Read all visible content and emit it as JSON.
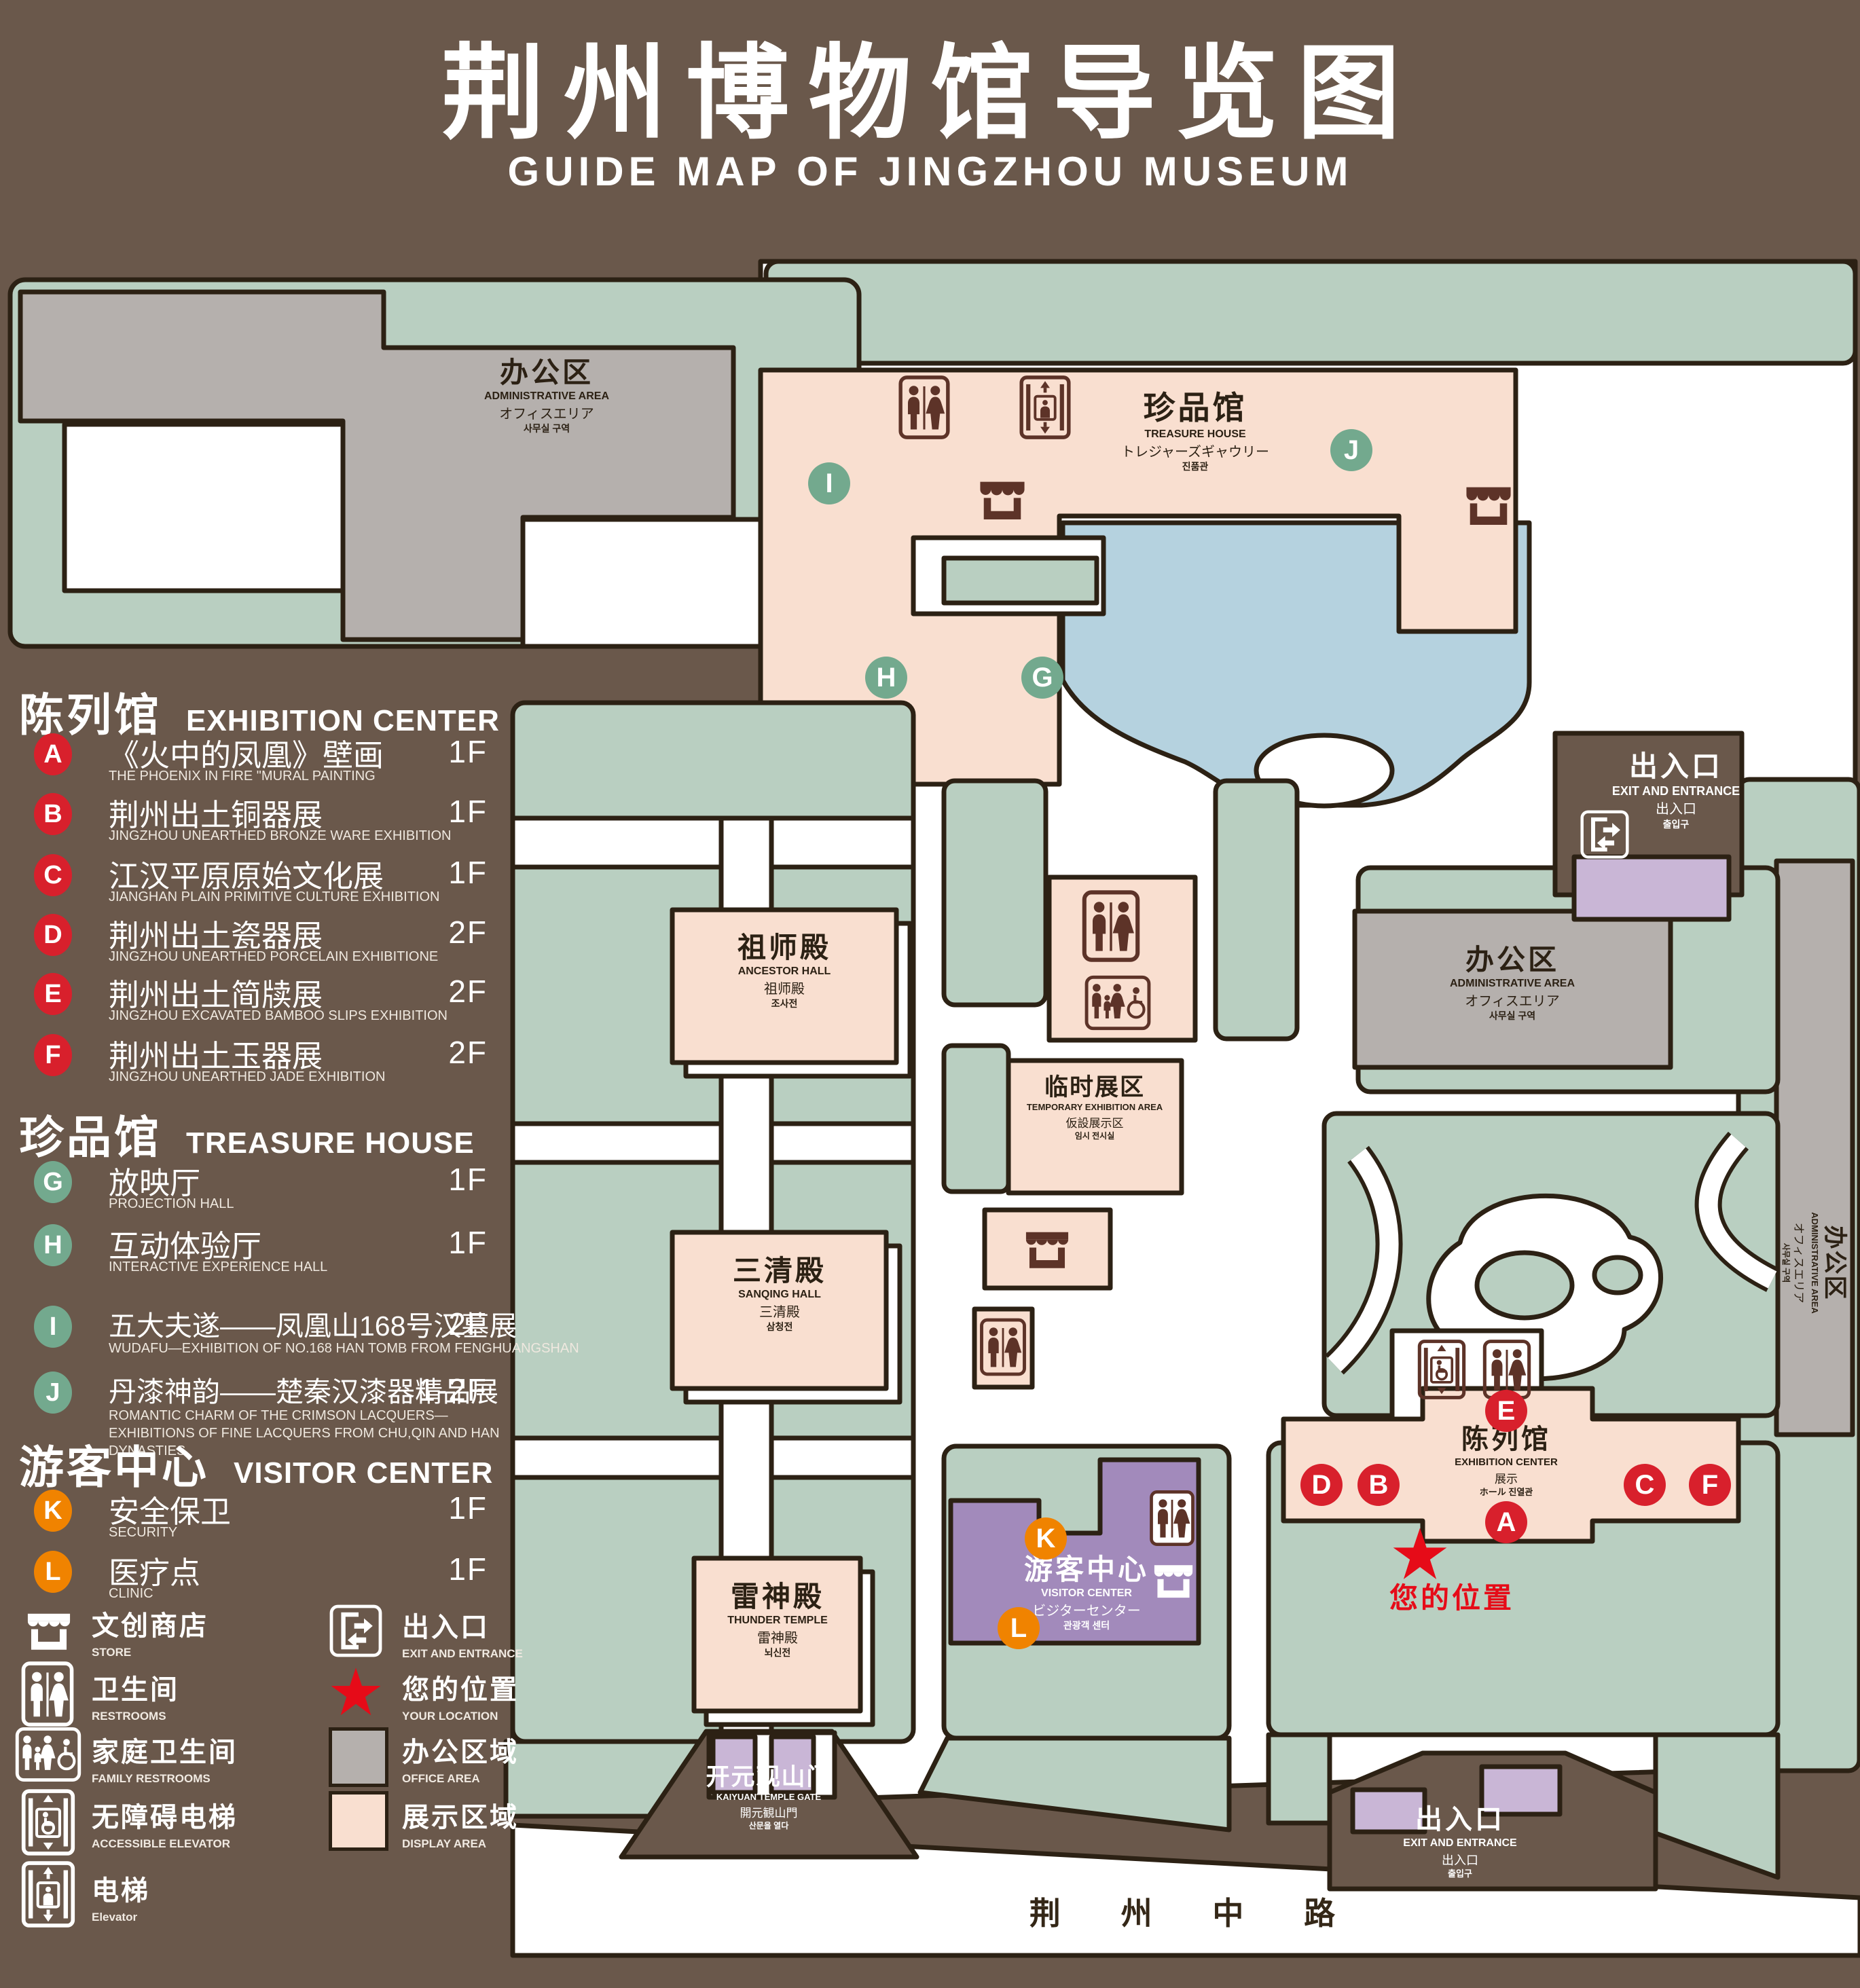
{
  "title": {
    "zh": "荆州博物馆导览图",
    "en": "GUIDE MAP OF JINGZHOU MUSEUM"
  },
  "legend": {
    "sections": [
      {
        "zh": "陈列馆",
        "en": "EXHIBITION CENTER",
        "items": [
          {
            "letter": "A",
            "zh": "《火中的凤凰》壁画",
            "en": "THE PHOENIX IN FIRE \"MURAL PAINTING",
            "floor": "1F"
          },
          {
            "letter": "B",
            "zh": "荆州出土铜器展",
            "en": "JINGZHOU UNEARTHED BRONZE WARE EXHIBITION",
            "floor": "1F"
          },
          {
            "letter": "C",
            "zh": "江汉平原原始文化展",
            "en": "JIANGHAN PLAIN PRIMITIVE CULTURE EXHIBITION",
            "floor": "1F"
          },
          {
            "letter": "D",
            "zh": "荆州出土瓷器展",
            "en": "JINGZHOU UNEARTHED PORCELAIN EXHIBITIONE",
            "floor": "2F"
          },
          {
            "letter": "E",
            "zh": "荆州出土简牍展",
            "en": "JINGZHOU EXCAVATED BAMBOO SLIPS EXHIBITION",
            "floor": "2F"
          },
          {
            "letter": "F",
            "zh": "荆州出土玉器展",
            "en": "JINGZHOU UNEARTHED JADE EXHIBITION",
            "floor": "2F"
          }
        ]
      },
      {
        "zh": "珍品馆",
        "en": "TREASURE HOUSE",
        "items": [
          {
            "letter": "G",
            "zh": "放映厅",
            "en": "PROJECTION HALL",
            "floor": "1F"
          },
          {
            "letter": "H",
            "zh": "互动体验厅",
            "en": "INTERACTIVE EXPERIENCE HALL",
            "floor": "1F"
          },
          {
            "letter": "I",
            "zh": "五大夫遂——凤凰山168号汉墓展",
            "en": "WUDAFU—EXHIBITION OF NO.168 HAN TOMB FROM FENGHUANGSHAN",
            "floor": "2F"
          },
          {
            "letter": "J",
            "zh": "丹漆神韵——楚秦汉漆器精品展",
            "en": "ROMANTIC CHARM OF THE CRIMSON LACQUERS—EXHIBITIONS OF FINE LACQUERS FROM CHU,QIN AND HAN DYNASTIES",
            "floor": "1-2F"
          }
        ]
      },
      {
        "zh": "游客中心",
        "en": "VISITOR CENTER",
        "items": [
          {
            "letter": "K",
            "zh": "安全保卫",
            "en": "SECURITY",
            "floor": "1F"
          },
          {
            "letter": "L",
            "zh": "医疗点",
            "en": "CLINIC",
            "floor": "1F"
          }
        ]
      }
    ],
    "symbols": [
      {
        "icon": "store-icon",
        "zh": "文创商店",
        "en": "STORE"
      },
      {
        "icon": "exit-icon",
        "zh": "出入口",
        "en": "EXIT AND ENTRANCE"
      },
      {
        "icon": "restrooms-icon",
        "zh": "卫生间",
        "en": "RESTROOMS"
      },
      {
        "icon": "your-location-star-icon",
        "zh": "您的位置",
        "en": "YOUR LOCATION"
      },
      {
        "icon": "family-restrooms-icon",
        "zh": "家庭卫生间",
        "en": "FAMILY RESTROOMS"
      },
      {
        "icon": "office-area-swatch",
        "zh": "办公区域",
        "en": "OFFICE AREA"
      },
      {
        "icon": "accessible-elevator-icon",
        "zh": "无障碍电梯",
        "en": "ACCESSIBLE ELEVATOR"
      },
      {
        "icon": "display-area-swatch",
        "zh": "展示区域",
        "en": "DISPLAY AREA"
      },
      {
        "icon": "elevator-icon",
        "zh": "电梯",
        "en": "Elevator"
      }
    ]
  },
  "map": {
    "labels": {
      "admin": {
        "zh": "办公区",
        "en": "ADMINISTRATIVE AREA",
        "ja": "オフィスエリア",
        "ko": "사무실 구역"
      },
      "treasure": {
        "zh": "珍品馆",
        "en": "TREASURE HOUSE",
        "ja": "トレジャーズギャウリー",
        "ko": "진품관"
      },
      "ancestor": {
        "zh": "祖师殿",
        "en": "ANCESTOR HALL",
        "ja": "祖师殿",
        "ko": "조사전"
      },
      "temporary": {
        "zh": "临时展区",
        "en": "TEMPORARY EXHIBITION AREA",
        "ja": "仮設展示区",
        "ko": "임시 전시실"
      },
      "sanqing": {
        "zh": "三清殿",
        "en": "SANQING HALL",
        "ja": "三清殿",
        "ko": "삼청전"
      },
      "thunder": {
        "zh": "雷神殿",
        "en": "THUNDER TEMPLE",
        "ja": "雷神殿",
        "ko": "뇌신전"
      },
      "visitor": {
        "zh": "游客中心",
        "en": "VISITOR CENTER",
        "ja": "ビジターセンター",
        "ko": "관광객 센터"
      },
      "exhibition": {
        "zh": "陈列馆",
        "en": "EXHIBITION CENTER",
        "ja": "展示",
        "ko": "ホール 진열관"
      },
      "exit": {
        "zh": "出入口",
        "en": "EXIT AND ENTRANCE",
        "ja": "出入口",
        "ko": "출입구"
      },
      "gate": {
        "zh": "开元观山门",
        "en": "KAIYUAN TEMPLE GATE",
        "ja": "開元観山門",
        "ko": "산문을 열다"
      },
      "road": "荆 州 中 路",
      "your_location": "您的位置"
    },
    "markers": [
      {
        "letter": "A"
      },
      {
        "letter": "B"
      },
      {
        "letter": "C"
      },
      {
        "letter": "D"
      },
      {
        "letter": "E"
      },
      {
        "letter": "F"
      },
      {
        "letter": "G"
      },
      {
        "letter": "H"
      },
      {
        "letter": "I"
      },
      {
        "letter": "J"
      },
      {
        "letter": "K"
      },
      {
        "letter": "L"
      }
    ]
  },
  "colors": {
    "background": "#6a584b",
    "outline": "#2c2114",
    "lawn_green": "#b9cfc1",
    "display_area": "#f9dfd0",
    "office_area": "#b5b0ad",
    "water": "#b5d2df",
    "visitor_purple": "#a28abb",
    "entrance_purple": "#c9b6d6",
    "marker_red": "#d8202c",
    "marker_green": "#73a98e",
    "marker_orange": "#f08300",
    "location_red": "#e60b18"
  }
}
